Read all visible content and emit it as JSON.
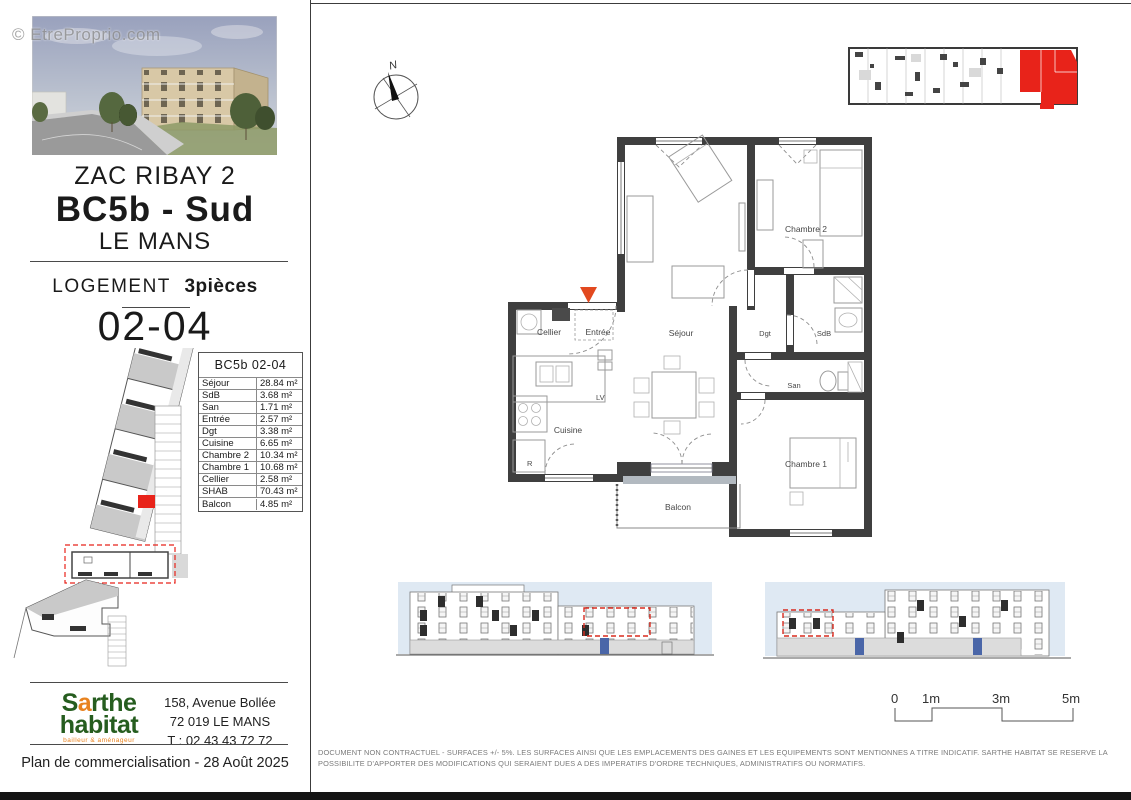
{
  "watermark": "© EtreProprio.com",
  "sidebar": {
    "title": {
      "line1": "ZAC RIBAY 2",
      "line2": "BC5b - Sud",
      "line3": "LE MANS"
    },
    "logement": {
      "label": "LOGEMENT",
      "type": "3pièces",
      "unit": "02-04"
    },
    "surface_table": {
      "title": "BC5b 02-04",
      "rows": [
        {
          "label": "Séjour",
          "value": "28.84 m²"
        },
        {
          "label": "SdB",
          "value": "3.68 m²"
        },
        {
          "label": "San",
          "value": "1.71 m²"
        },
        {
          "label": "Entrée",
          "value": "2.57 m²"
        },
        {
          "label": "Dgt",
          "value": "3.38 m²"
        },
        {
          "label": "Cuisine",
          "value": "6.65 m²"
        },
        {
          "label": "Chambre 2",
          "value": "10.34 m²"
        },
        {
          "label": "Chambre 1",
          "value": "10.68 m²"
        },
        {
          "label": "Cellier",
          "value": "2.58 m²"
        },
        {
          "label": "SHAB",
          "value": "70.43 m²"
        }
      ],
      "balcony": {
        "label": "Balcon",
        "value": "4.85 m²"
      }
    },
    "logo": {
      "word1_prefix": "S",
      "word1_accent": "a",
      "word1_suffix": "rthe",
      "word2": "habitat",
      "tagline": "bailleur & aménageur"
    },
    "address": {
      "line1": "158, Avenue Bollée",
      "line2": "72 019 LE MANS",
      "line3": "T : 02 43 43 72 72"
    },
    "plan_date": "Plan de commercialisation - 28 Août 2025"
  },
  "plan": {
    "compass": "N",
    "rooms": {
      "cellier": "Cellier",
      "entree": "Entrée",
      "sejour": "Séjour",
      "chambre2": "Chambre 2",
      "dgt": "Dgt",
      "sdb": "SdB",
      "san": "San",
      "cuisine": "Cuisine",
      "chambre1": "Chambre 1",
      "balcon": "Balcon"
    },
    "labels": {
      "lv": "LV",
      "r": "R"
    },
    "scale": {
      "t0": "0",
      "t1": "1m",
      "t3": "3m",
      "t5": "5m"
    }
  },
  "disclaimer": "DOCUMENT NON CONTRACTUEL - SURFACES +/- 5%. LES SURFACES AINSI QUE LES EMPLACEMENTS DES GAINES ET LES EQUIPEMENTS SONT MENTIONNES A TITRE INDICATIF. SARTHE HABITAT SE RESERVE LA POSSIBILITE D'APPORTER DES MODIFICATIONS QUI SERAIENT DUES A DES IMPERATIFS D'ORDRE TECHNIQUES, ADMINISTRATIFS OU NORMATIFS.",
  "colors": {
    "highlight_red": "#e8231a",
    "entry_arrow": "#e2491f",
    "logo_green": "#265d1f",
    "logo_orange": "#e8821e",
    "elevation_sky": "#dfe9f3"
  }
}
